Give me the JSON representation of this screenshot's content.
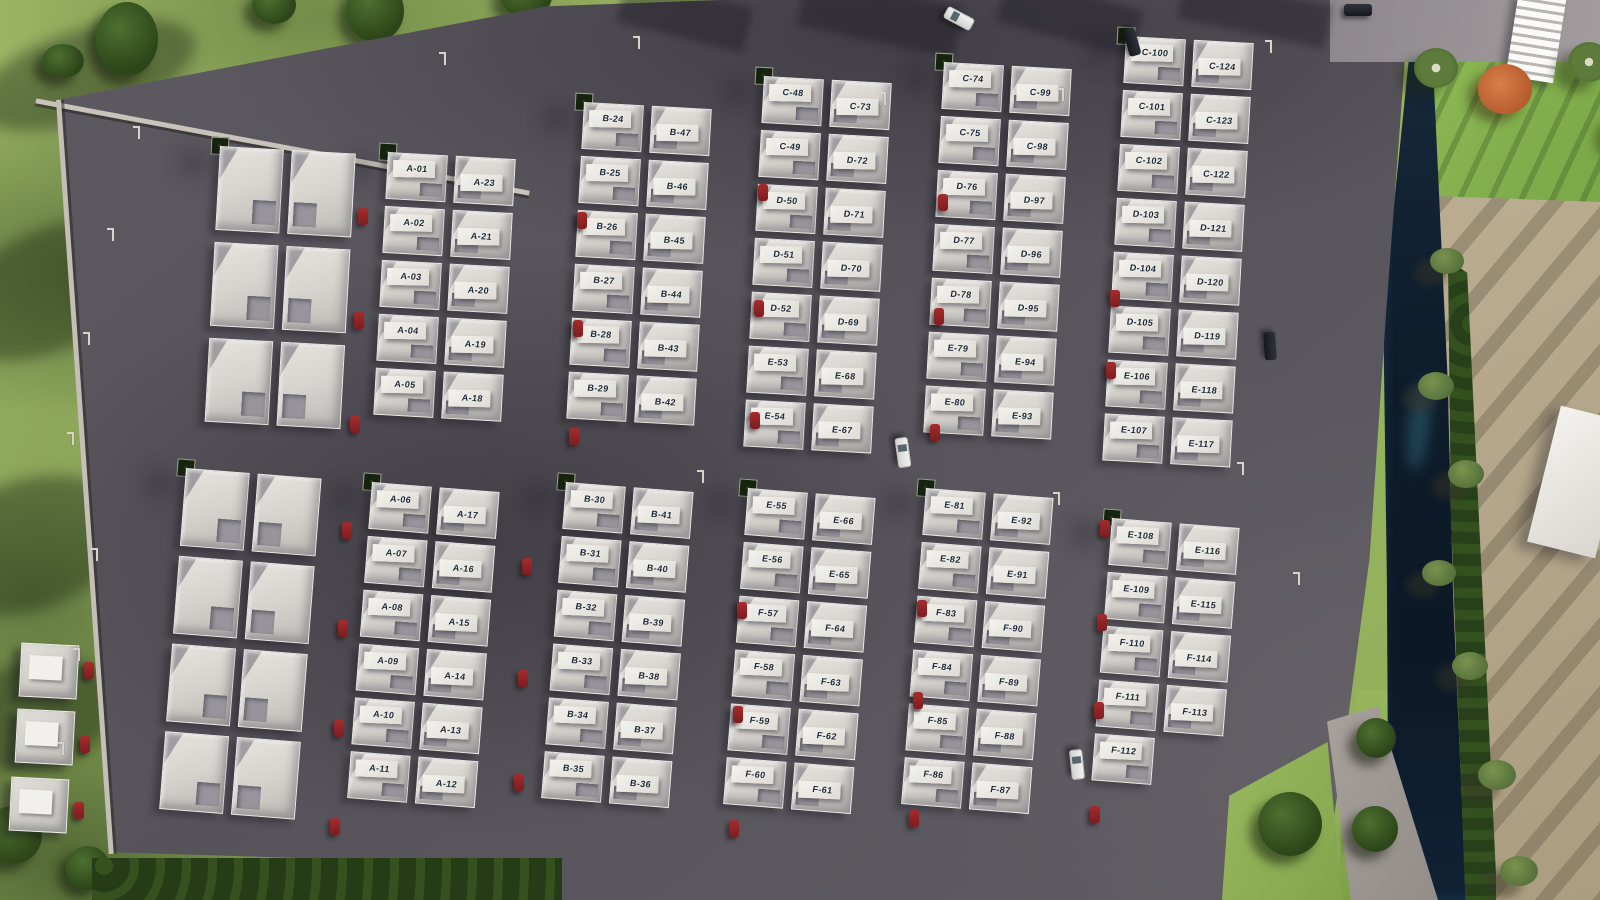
{
  "site": {
    "description_label": "",
    "colors": {
      "asphalt": "#57535b",
      "grass": "#9cb863",
      "hedge": "#243a15",
      "water": "#0e1d2c",
      "roof": "#d6d3ce",
      "label_text": "#1d2633",
      "parked_car": "#8c2124",
      "sand": "#b3a489"
    }
  },
  "blocks": [
    {
      "name": "block-a-upper",
      "units": [
        [
          "A-01",
          "A-23"
        ],
        [
          "A-02",
          "A-21"
        ],
        [
          "A-03",
          "A-20"
        ],
        [
          "A-04",
          "A-19"
        ],
        [
          "A-05",
          "A-18"
        ]
      ]
    },
    {
      "name": "block-a-lower",
      "units": [
        [
          "A-06",
          "A-17"
        ],
        [
          "A-07",
          "A-16"
        ],
        [
          "A-08",
          "A-15"
        ],
        [
          "A-09",
          "A-14"
        ],
        [
          "A-10",
          "A-13"
        ],
        [
          "A-11",
          "A-12"
        ]
      ]
    },
    {
      "name": "block-b-upper",
      "units": [
        [
          "B-24",
          "B-47"
        ],
        [
          "B-25",
          "B-46"
        ],
        [
          "B-26",
          "B-45"
        ],
        [
          "B-27",
          "B-44"
        ],
        [
          "B-28",
          "B-43"
        ],
        [
          "B-29",
          "B-42"
        ]
      ]
    },
    {
      "name": "block-b-lower",
      "units": [
        [
          "B-30",
          "B-41"
        ],
        [
          "B-31",
          "B-40"
        ],
        [
          "B-32",
          "B-39"
        ],
        [
          "B-33",
          "B-38"
        ],
        [
          "B-34",
          "B-37"
        ],
        [
          "B-35",
          "B-36"
        ]
      ]
    },
    {
      "name": "block-cde-upper-1",
      "units": [
        [
          "C-48",
          "C-73"
        ],
        [
          "C-49",
          "D-72"
        ],
        [
          "D-50",
          "D-71"
        ],
        [
          "D-51",
          "D-70"
        ],
        [
          "D-52",
          "D-69"
        ],
        [
          "E-53",
          "E-68"
        ],
        [
          "E-54",
          "E-67"
        ]
      ]
    },
    {
      "name": "block-ef-lower-1",
      "units": [
        [
          "E-55",
          "E-66"
        ],
        [
          "E-56",
          "E-65"
        ],
        [
          "F-57",
          "F-64"
        ],
        [
          "F-58",
          "F-63"
        ],
        [
          "F-59",
          "F-62"
        ],
        [
          "F-60",
          "F-61"
        ]
      ]
    },
    {
      "name": "block-cde-upper-2",
      "units": [
        [
          "C-74",
          "C-99"
        ],
        [
          "C-75",
          "C-98"
        ],
        [
          "D-76",
          "D-97"
        ],
        [
          "D-77",
          "D-96"
        ],
        [
          "D-78",
          "D-95"
        ],
        [
          "E-79",
          "E-94"
        ],
        [
          "E-80",
          "E-93"
        ]
      ]
    },
    {
      "name": "block-ef-lower-2",
      "units": [
        [
          "E-81",
          "E-92"
        ],
        [
          "E-82",
          "E-91"
        ],
        [
          "F-83",
          "F-90"
        ],
        [
          "F-84",
          "F-89"
        ],
        [
          "F-85",
          "F-88"
        ],
        [
          "F-86",
          "F-87"
        ]
      ]
    },
    {
      "name": "block-cde-upper-3",
      "units": [
        [
          "C-100",
          "C-124"
        ],
        [
          "C-101",
          "C-123"
        ],
        [
          "C-102",
          "C-122"
        ],
        [
          "D-103",
          "D-121"
        ],
        [
          "D-104",
          "D-120"
        ],
        [
          "D-105",
          "D-119"
        ],
        [
          "E-106",
          "E-118"
        ],
        [
          "E-107",
          "E-117"
        ]
      ]
    },
    {
      "name": "block-ef-lower-3",
      "units": [
        [
          "E-108",
          "E-116"
        ],
        [
          "E-109",
          "E-115"
        ],
        [
          "F-110",
          "F-114"
        ],
        [
          "F-111",
          "F-113"
        ],
        [
          "F-112",
          null
        ]
      ]
    },
    {
      "name": "block-unlabeled-upper",
      "units": [
        [
          null,
          null
        ],
        [
          null,
          null
        ],
        [
          null,
          null
        ]
      ]
    },
    {
      "name": "block-unlabeled-lower",
      "units": [
        [
          null,
          null
        ],
        [
          null,
          null
        ],
        [
          null,
          null
        ],
        [
          null,
          null
        ]
      ]
    }
  ]
}
